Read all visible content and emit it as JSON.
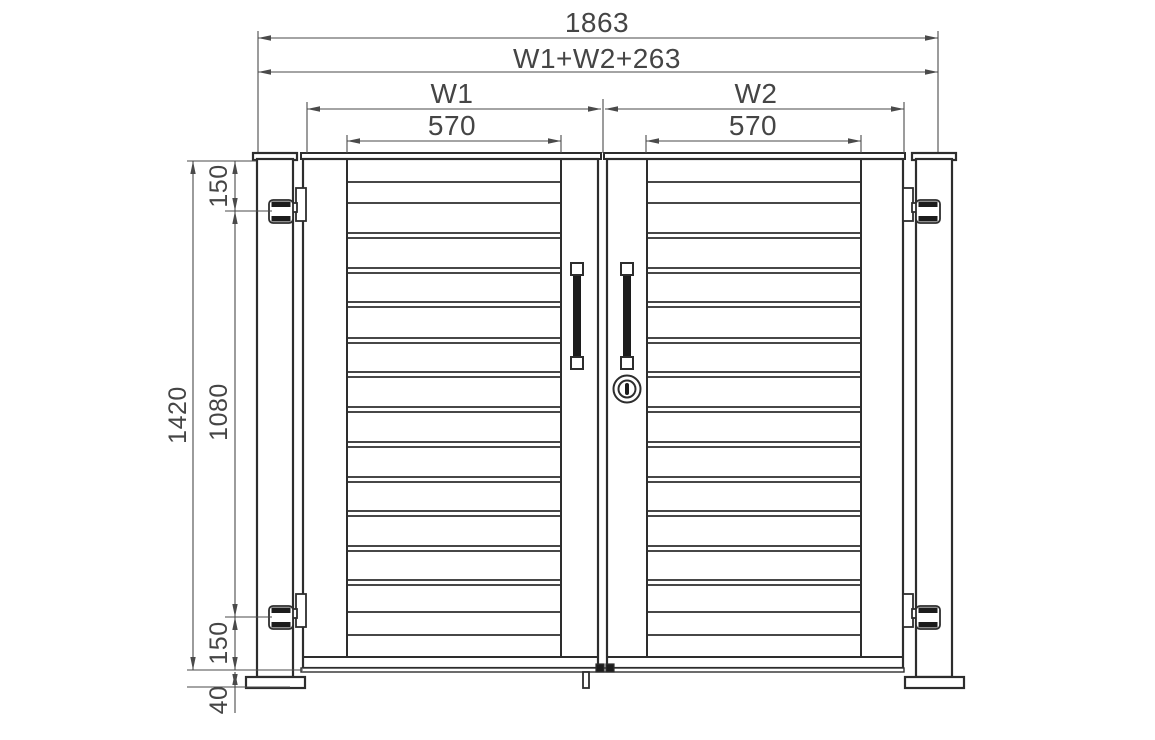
{
  "title": "Double swing gate - front elevation technical drawing",
  "colors": {
    "object_line": "#2d2d2d",
    "dim_line": "#4a4a4a",
    "text": "#454545",
    "dark_fill": "#1c1c1c",
    "background": "#ffffff"
  },
  "dimensions": {
    "overall_width": {
      "label": "1863",
      "value": 1863,
      "unit": "mm"
    },
    "formula_width": {
      "label": "W1+W2+263"
    },
    "leaf1_width": {
      "label": "W1"
    },
    "leaf2_width": {
      "label": "W2"
    },
    "infill1_width": {
      "label": "570",
      "value": 570,
      "unit": "mm"
    },
    "infill2_width": {
      "label": "570",
      "value": 570,
      "unit": "mm"
    },
    "overall_height": {
      "label": "1420",
      "value": 1420,
      "unit": "mm"
    },
    "hinge_top_offset": {
      "label": "150",
      "value": 150,
      "unit": "mm"
    },
    "hinge_spacing": {
      "label": "1080",
      "value": 1080,
      "unit": "mm"
    },
    "hinge_bottom_offset": {
      "label": "150",
      "value": 150,
      "unit": "mm"
    },
    "ground_clearance": {
      "label": "40",
      "value": 40,
      "unit": "mm"
    }
  },
  "geometry": {
    "canvas": {
      "w": 1155,
      "h": 740
    },
    "posts": [
      {
        "cap": [
          253,
          153,
          44,
          7
        ],
        "body": [
          257,
          159,
          36,
          518
        ],
        "plate": [
          246,
          677,
          59,
          11
        ]
      },
      {
        "cap": [
          912,
          153,
          44,
          7
        ],
        "body": [
          916,
          159,
          36,
          518
        ],
        "plate": [
          905,
          677,
          59,
          11
        ]
      }
    ],
    "leaves": [
      {
        "cap": [
          301,
          153,
          300,
          6
        ],
        "frame": [
          303,
          159,
          295,
          509
        ],
        "slat_x": [
          347,
          561
        ]
      },
      {
        "cap": [
          604,
          153,
          301,
          6
        ],
        "frame": [
          607,
          159,
          296,
          509
        ],
        "slat_x": [
          647,
          861
        ]
      }
    ],
    "slat_single_lines": [
      182,
      203,
      612,
      635
    ],
    "slat_gap_bands": [
      [
        233,
        238
      ],
      [
        268,
        273
      ],
      [
        302,
        307
      ],
      [
        338,
        343
      ],
      [
        372,
        377
      ],
      [
        407,
        412
      ],
      [
        442,
        447
      ],
      [
        477,
        482
      ],
      [
        511,
        516
      ],
      [
        546,
        551
      ],
      [
        580,
        585
      ]
    ],
    "stile_top_y": 160,
    "rail_bottom_y": 657,
    "bottom_strip": [
      301,
      668,
      603,
      4
    ],
    "drop_rod": [
      583,
      672,
      6,
      16
    ],
    "latch_blocks": [
      [
        596,
        664,
        8,
        8
      ],
      [
        606,
        664,
        8,
        8
      ]
    ],
    "hinges": [
      {
        "bracket": [
          296,
          188,
          10,
          33
        ],
        "nub": [
          291,
          203,
          6,
          9
        ],
        "barrel": [
          269,
          200,
          24,
          23
        ]
      },
      {
        "bracket": [
          296,
          594,
          10,
          33
        ],
        "nub": [
          291,
          609,
          6,
          9
        ],
        "barrel": [
          269,
          606,
          24,
          23
        ]
      },
      {
        "bracket": [
          903,
          188,
          10,
          33
        ],
        "nub": [
          912,
          203,
          6,
          9
        ],
        "barrel": [
          916,
          200,
          24,
          23
        ]
      },
      {
        "bracket": [
          903,
          594,
          10,
          33
        ],
        "nub": [
          912,
          609,
          6,
          9
        ],
        "barrel": [
          916,
          606,
          24,
          23
        ]
      }
    ],
    "handles": [
      {
        "top_sq": [
          571,
          263,
          12,
          12
        ],
        "bar": [
          573,
          274,
          8,
          84
        ],
        "bot_sq": [
          571,
          357,
          12,
          12
        ]
      },
      {
        "top_sq": [
          621,
          263,
          12,
          12
        ],
        "bar": [
          623,
          274,
          8,
          84
        ],
        "bot_sq": [
          621,
          357,
          12,
          12
        ]
      }
    ],
    "lock": {
      "cx": 627,
      "cy": 389,
      "r_outer": 13.5,
      "r_inner": 8.5,
      "slot": [
        625,
        383,
        4,
        12
      ]
    },
    "hdims": [
      {
        "y": 38,
        "x1": 258,
        "x2": 938
      },
      {
        "y": 72,
        "x1": 258,
        "x2": 938
      },
      {
        "y": 109,
        "x1": 307,
        "x2": 601
      },
      {
        "y": 109,
        "x1": 605,
        "x2": 904
      },
      {
        "y": 141,
        "x1": 347,
        "x2": 561
      },
      {
        "y": 141,
        "x1": 646,
        "x2": 861
      }
    ],
    "vdims": [
      {
        "x": 193,
        "y1": 161,
        "y2": 670
      },
      {
        "x": 235,
        "y1": 161,
        "y2": 211
      },
      {
        "x": 235,
        "y1": 211,
        "y2": 617
      },
      {
        "x": 235,
        "y1": 617,
        "y2": 670
      },
      {
        "x": 235,
        "y1": 672,
        "y2": 687,
        "tail": 713
      }
    ],
    "ext_lines": [
      [
        258,
        31,
        258,
        152
      ],
      [
        938,
        31,
        938,
        152
      ],
      [
        307,
        102,
        307,
        153
      ],
      [
        603,
        99,
        603,
        153
      ],
      [
        904,
        102,
        904,
        153
      ],
      [
        347,
        135,
        347,
        153
      ],
      [
        561,
        135,
        561,
        153
      ],
      [
        646,
        135,
        646,
        153
      ],
      [
        861,
        135,
        861,
        153
      ],
      [
        187,
        161,
        256,
        161
      ],
      [
        225,
        211,
        272,
        211
      ],
      [
        225,
        617,
        272,
        617
      ],
      [
        187,
        670,
        303,
        670
      ],
      [
        187,
        687,
        290,
        687
      ]
    ]
  }
}
